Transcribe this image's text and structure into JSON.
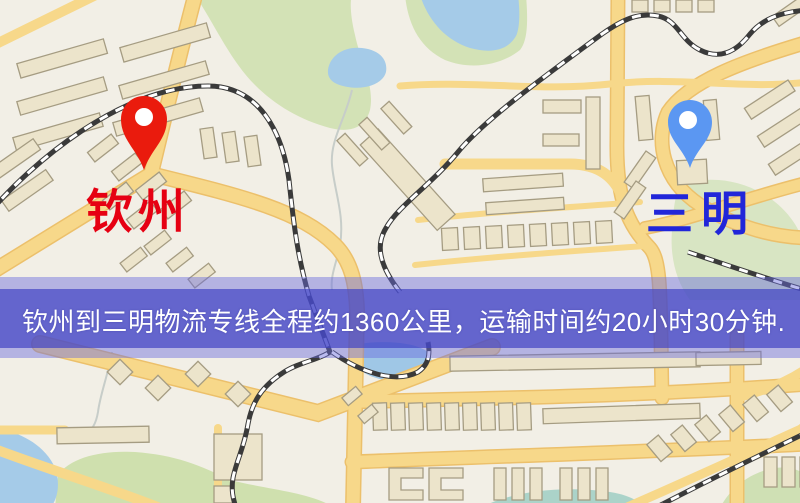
{
  "markers": {
    "origin": {
      "name": "钦州",
      "pin_color": "#ea1b0d",
      "label_color": "#e60012"
    },
    "destination": {
      "name": "三明",
      "pin_color": "#5b97f2",
      "label_color": "#2126d9"
    }
  },
  "banner": {
    "text": "钦州到三明物流专线全程约1360公里，运输时间约20小时30分钟.",
    "distance": "约1360公里",
    "duration": "约20小时30分钟",
    "background_color": "#6061ca",
    "text_color": "#ffffff"
  },
  "map_palette": {
    "background": "#f2efe6",
    "road": "#f7d88a",
    "road_casing": "#ecc06b",
    "building": "#ece4cb",
    "building_outline": "#a59c82",
    "green_area": "#d3e2b6",
    "water": "#a5cbe8",
    "railway_dark": "#3a3a3a",
    "railway_light": "#ffffff"
  }
}
